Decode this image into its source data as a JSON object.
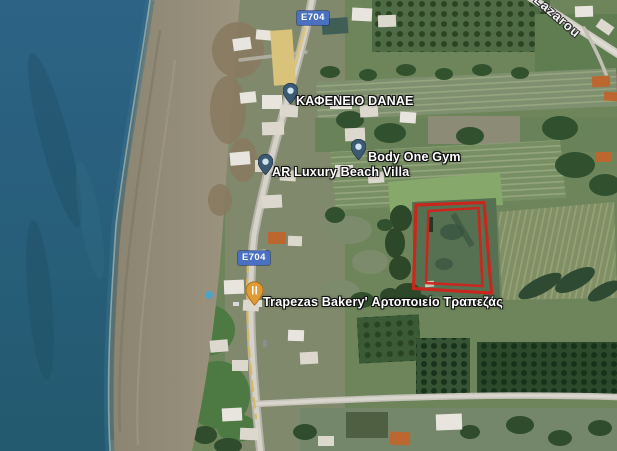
{
  "map_view": {
    "type": "satellite-imagery",
    "route_badges": [
      {
        "id": "e704-north",
        "label": "E704"
      },
      {
        "id": "e704-south",
        "label": "E704"
      }
    ],
    "street_labels": [
      {
        "id": "lazarou",
        "text": "Lazarou"
      }
    ],
    "places": [
      {
        "id": "kafeneio-danae",
        "label": "ΚΑΦΕΝΕΙΟ DANAE",
        "pin_icon": "blue-poi-pin"
      },
      {
        "id": "body-one-gym",
        "label": "Body One Gym",
        "pin_icon": "blue-poi-pin"
      },
      {
        "id": "ar-luxury-beach-villa",
        "label": "AR Luxury Beach Villa",
        "pin_icon": "blue-poi-pin"
      },
      {
        "id": "trapezas-bakery",
        "label": "Trapezas Bakery' Αρτοποιείο Τραπεζάς",
        "pin_icon": "orange-restaurant-pin"
      }
    ],
    "annotations": [
      {
        "id": "property-boundary",
        "shape": "double-outlined-quadrilateral",
        "color": "#cf241c"
      }
    ],
    "colors": {
      "sea": "#2a5f7e",
      "beach": "#948c78",
      "fields": "#6e855c",
      "route_badge_blue": "#4a70c2",
      "parcel_outline": "#cf241c",
      "poi_pin_blue": "#3d5a73",
      "restaurant_pin_orange": "#e09a36"
    }
  }
}
